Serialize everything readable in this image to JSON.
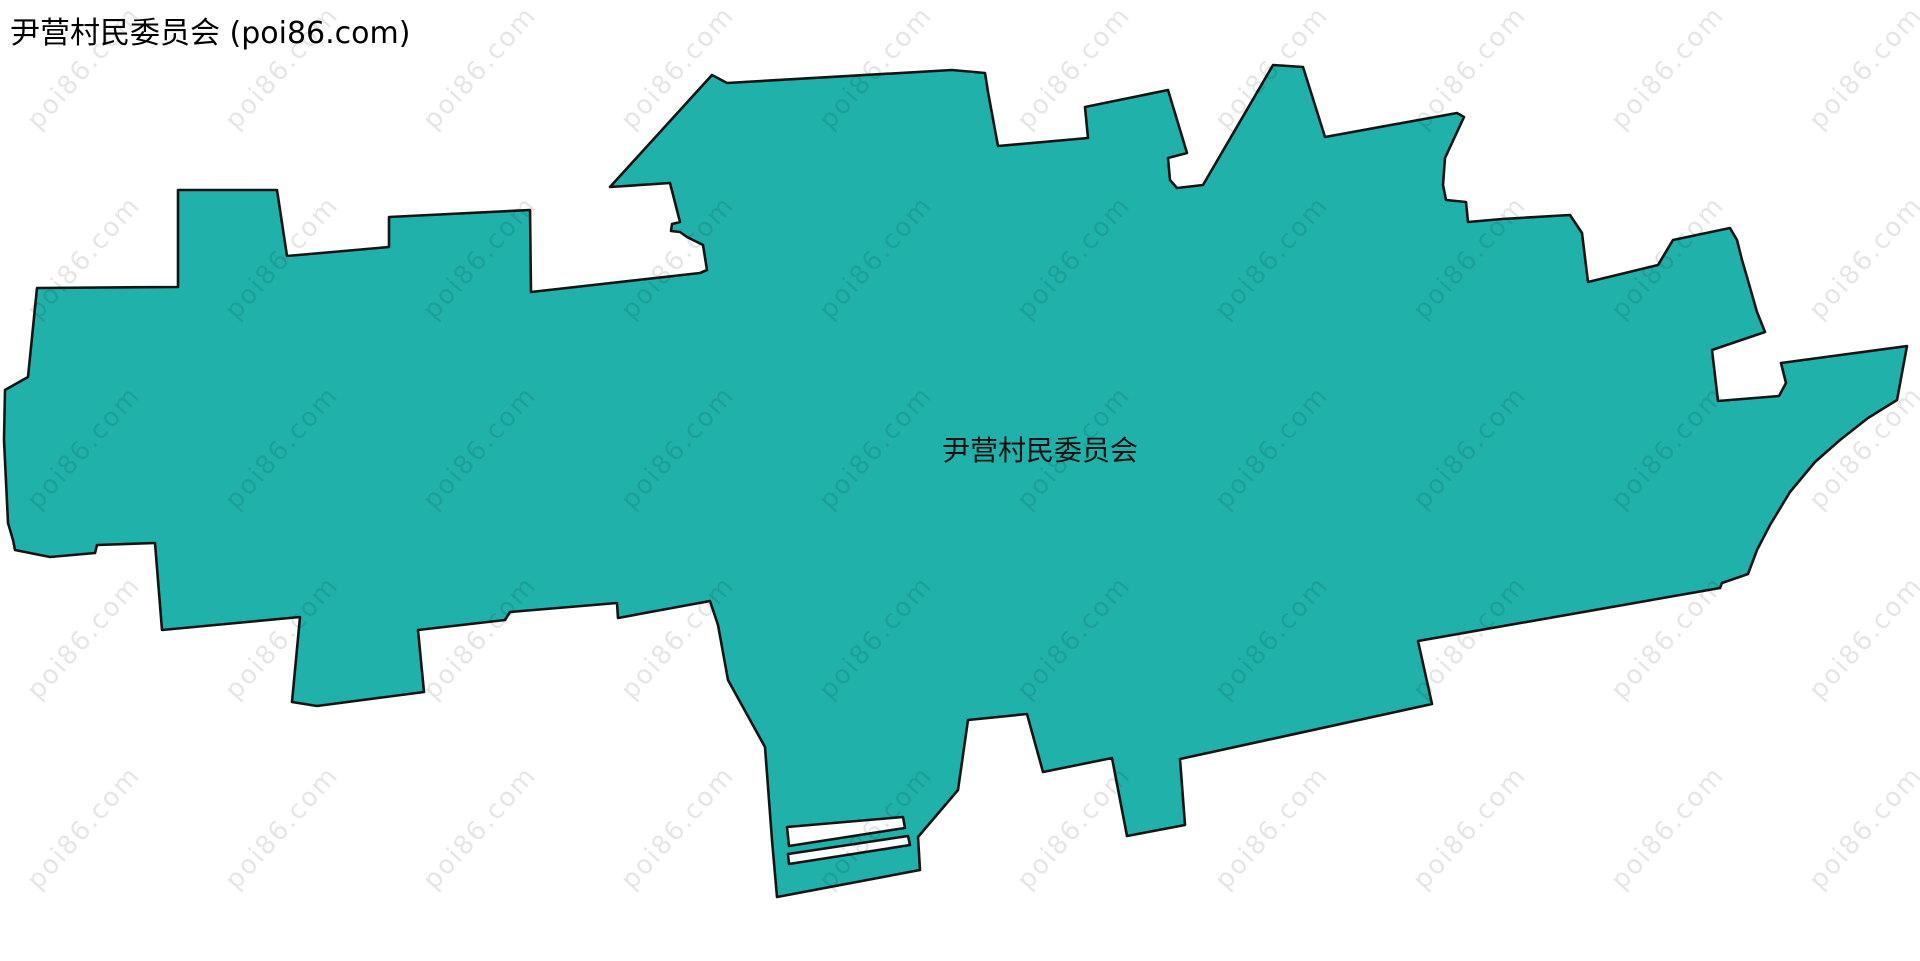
{
  "page": {
    "width": 1920,
    "height": 961,
    "background": "#ffffff"
  },
  "header": {
    "title": "尹营村民委员会 (poi86.com)"
  },
  "map": {
    "region_label": "尹营村民委员会",
    "label_position": {
      "x": 1040,
      "y": 449
    },
    "colors": {
      "fill": "#20b2aa",
      "outline": "#141414",
      "label": "#111111",
      "title": "#000000",
      "watermark": "rgba(0,0,0,0.10)"
    },
    "boundary": {
      "outer": [
        [
          178,
          190
        ],
        [
          277,
          190
        ],
        [
          287,
          256
        ],
        [
          389,
          247
        ],
        [
          389,
          217
        ],
        [
          530,
          210
        ],
        [
          531,
          292
        ],
        [
          700,
          273
        ],
        [
          707,
          270
        ],
        [
          703,
          245
        ],
        [
          687,
          237
        ],
        [
          680,
          232
        ],
        [
          671,
          231
        ],
        [
          672,
          224
        ],
        [
          680,
          222
        ],
        [
          670,
          183
        ],
        [
          610,
          187
        ],
        [
          712,
          75
        ],
        [
          727,
          83
        ],
        [
          952,
          70
        ],
        [
          985,
          73
        ],
        [
          988,
          92
        ],
        [
          998,
          146
        ],
        [
          1088,
          138
        ],
        [
          1085,
          107
        ],
        [
          1168,
          90
        ],
        [
          1187,
          153
        ],
        [
          1168,
          158
        ],
        [
          1170,
          180
        ],
        [
          1177,
          188
        ],
        [
          1203,
          185
        ],
        [
          1273,
          65
        ],
        [
          1303,
          67
        ],
        [
          1325,
          137
        ],
        [
          1457,
          113
        ],
        [
          1464,
          117
        ],
        [
          1445,
          158
        ],
        [
          1443,
          185
        ],
        [
          1446,
          200
        ],
        [
          1466,
          202
        ],
        [
          1468,
          222
        ],
        [
          1502,
          219
        ],
        [
          1570,
          215
        ],
        [
          1582,
          233
        ],
        [
          1588,
          282
        ],
        [
          1658,
          265
        ],
        [
          1673,
          240
        ],
        [
          1730,
          228
        ],
        [
          1737,
          240
        ],
        [
          1742,
          260
        ],
        [
          1747,
          277
        ],
        [
          1757,
          312
        ],
        [
          1765,
          332
        ],
        [
          1712,
          350
        ],
        [
          1718,
          401
        ],
        [
          1779,
          396
        ],
        [
          1786,
          383
        ],
        [
          1781,
          363
        ],
        [
          1907,
          346
        ],
        [
          1897,
          400
        ],
        [
          1868,
          418
        ],
        [
          1840,
          440
        ],
        [
          1815,
          462
        ],
        [
          1790,
          492
        ],
        [
          1770,
          525
        ],
        [
          1757,
          550
        ],
        [
          1748,
          574
        ],
        [
          1722,
          583
        ],
        [
          1720,
          588
        ],
        [
          1418,
          641
        ],
        [
          1432,
          704
        ],
        [
          1180,
          759
        ],
        [
          1185,
          825
        ],
        [
          1127,
          836
        ],
        [
          1112,
          758
        ],
        [
          1043,
          772
        ],
        [
          1027,
          714
        ],
        [
          968,
          720
        ],
        [
          958,
          790
        ],
        [
          918,
          837
        ],
        [
          920,
          870
        ],
        [
          777,
          897
        ],
        [
          772,
          840
        ],
        [
          765,
          747
        ],
        [
          728,
          680
        ],
        [
          718,
          625
        ],
        [
          710,
          601
        ],
        [
          618,
          618
        ],
        [
          617,
          603
        ],
        [
          510,
          612
        ],
        [
          505,
          620
        ],
        [
          418,
          630
        ],
        [
          424,
          692
        ],
        [
          317,
          706
        ],
        [
          292,
          702
        ],
        [
          300,
          617
        ],
        [
          247,
          622
        ],
        [
          162,
          630
        ],
        [
          155,
          543
        ],
        [
          97,
          545
        ],
        [
          95,
          553
        ],
        [
          50,
          557
        ],
        [
          15,
          550
        ],
        [
          13,
          540
        ],
        [
          8,
          523
        ],
        [
          4,
          440
        ],
        [
          5,
          390
        ],
        [
          28,
          377
        ],
        [
          37,
          288
        ],
        [
          178,
          287
        ]
      ],
      "holes": [
        [
          [
            787,
            827
          ],
          [
            903,
            817
          ],
          [
            905,
            828
          ],
          [
            789,
            846
          ]
        ],
        [
          [
            788,
            854
          ],
          [
            908,
            836
          ],
          [
            910,
            845
          ],
          [
            789,
            864
          ]
        ]
      ]
    }
  },
  "watermark": {
    "text": "poi86.com",
    "grid": {
      "start_x": 84,
      "start_y": 68,
      "step_x": 198,
      "step_y": 190,
      "cols": 10,
      "rows": 5
    }
  }
}
